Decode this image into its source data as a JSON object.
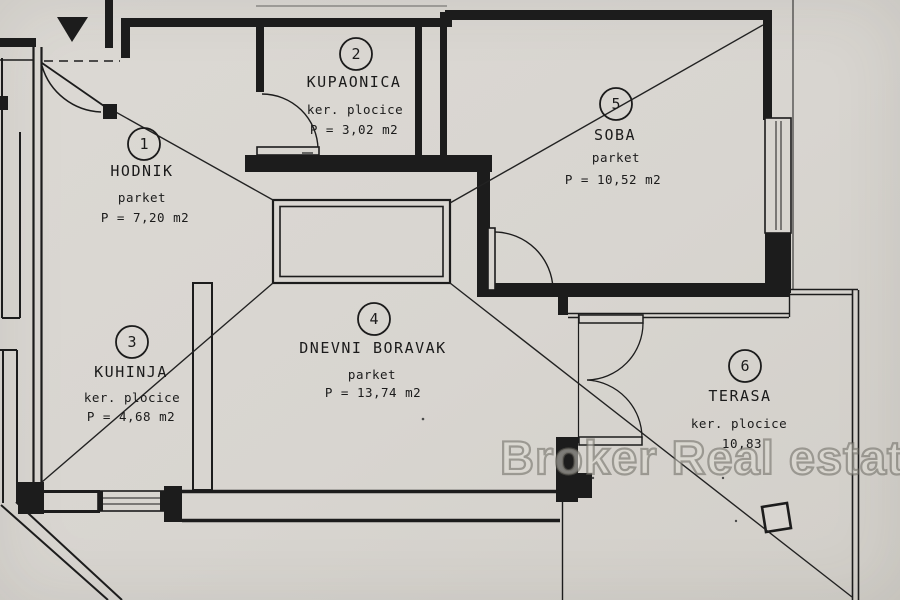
{
  "watermark": "Broker Real estate",
  "rooms": [
    {
      "number": "1",
      "name": "HODNIK",
      "floor": "parket",
      "area": "P = 7,20 m2"
    },
    {
      "number": "2",
      "name": "KUPAONICA",
      "floor": "ker. plocice",
      "area": "P = 3,02 m2"
    },
    {
      "number": "3",
      "name": "KUHINJA",
      "floor": "ker. plocice",
      "area": "P = 4,68 m2"
    },
    {
      "number": "4",
      "name": "DNEVNI BORAVAK",
      "floor": "parket",
      "area": "P = 13,74 m2"
    },
    {
      "number": "5",
      "name": "SOBA",
      "floor": "parket",
      "area": "P = 10,52 m2"
    },
    {
      "number": "6",
      "name": "TERASA",
      "floor": "ker. plocice",
      "area": "10,83"
    }
  ],
  "colors": {
    "paper": "#d8d5d0",
    "ink": "#1c1c1c",
    "watermark_gray": "#8f8c86"
  }
}
